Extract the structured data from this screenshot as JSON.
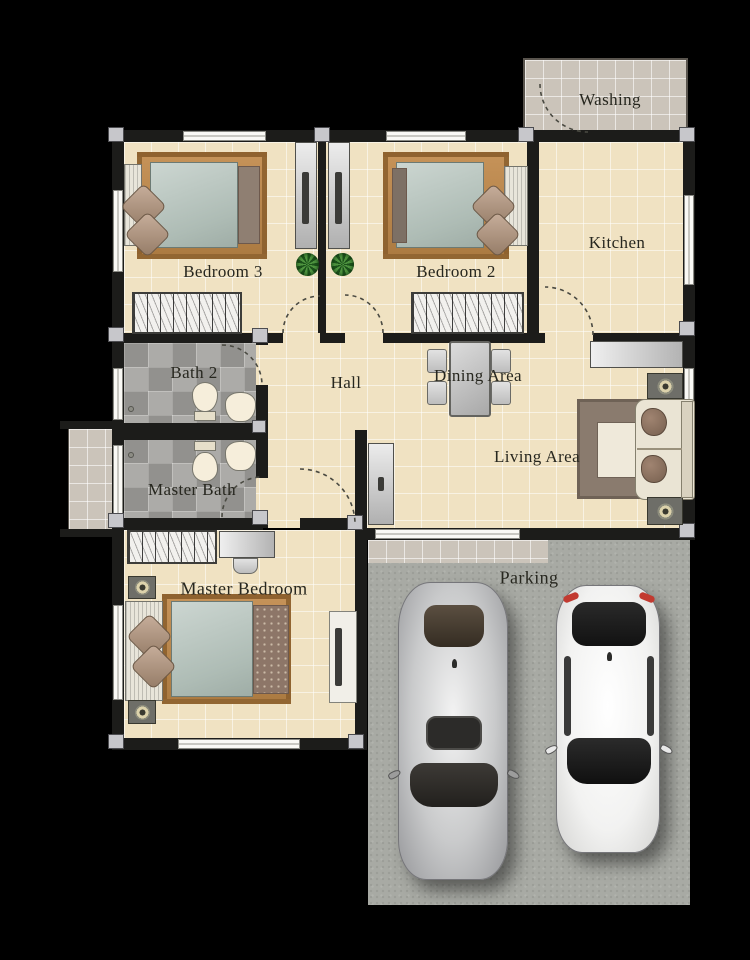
{
  "plan": {
    "rooms": {
      "washing": "Washing",
      "kitchen": "Kitchen",
      "bedroom3": "Bedroom 3",
      "bedroom2": "Bedroom 2",
      "hall": "Hall",
      "dining": "Dining Area",
      "bath2": "Bath 2",
      "master_bath": "Master Bath",
      "living": "Living Area",
      "master_bedroom": "Master Bedroom",
      "parking": "Parking"
    },
    "colors": {
      "background": "#000000",
      "floor_beige": "#f0e2c2",
      "outdoor_tile": "#cbc4ba",
      "bath_stone": "#a3a29e",
      "wall": "#1c1c1a",
      "concrete": "#a8aaa4",
      "rug_brown": "#b5834d",
      "mattress": "#b7c4be",
      "plant_green": "#2c6b2a",
      "car_silver": "#c3c4c5",
      "car_white": "#f4f4f3",
      "fixture_cream": "#f6eedb"
    }
  }
}
